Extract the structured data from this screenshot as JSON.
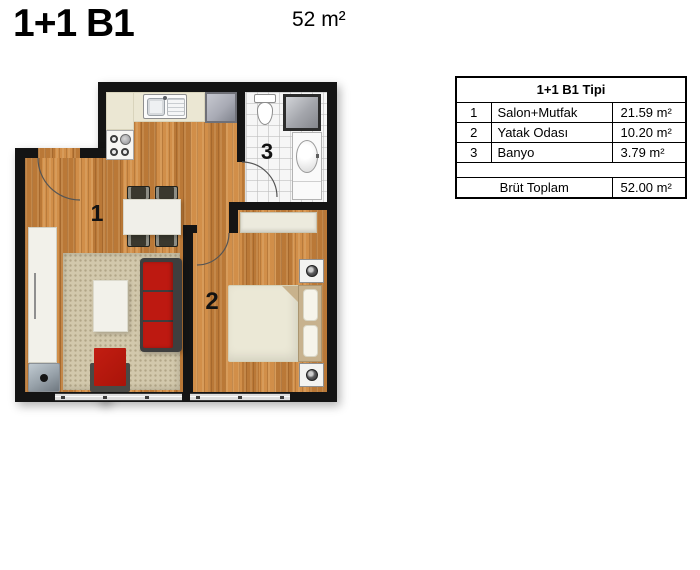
{
  "header": {
    "title": "1+1 B1",
    "area": "52 m²"
  },
  "spec_table": {
    "title": "1+1 B1 Tipi",
    "rows": [
      {
        "no": "1",
        "name": "Salon+Mutfak",
        "area": "21.59 m²"
      },
      {
        "no": "2",
        "name": "Yatak Odası",
        "area": "10.20 m²"
      },
      {
        "no": "3",
        "name": "Banyo",
        "area": "3.79 m²"
      }
    ],
    "total_label": "Brüt Toplam",
    "total_value": "52.00 m²"
  },
  "plan": {
    "labels": {
      "salon": "1",
      "bedroom": "2",
      "bathroom": "3"
    },
    "colors": {
      "wall": "#141414",
      "wood_floor": "#ca8843",
      "bath_tile": "#f6f6f6",
      "kitchen_counter": "#ebe7d3",
      "rug": "#d2c8ac",
      "sofa_red": "#bd1911",
      "pouf_red": "#b3150c",
      "bed_linen": "#ebe8d6",
      "headboard_tan": "#c7b28e"
    }
  }
}
